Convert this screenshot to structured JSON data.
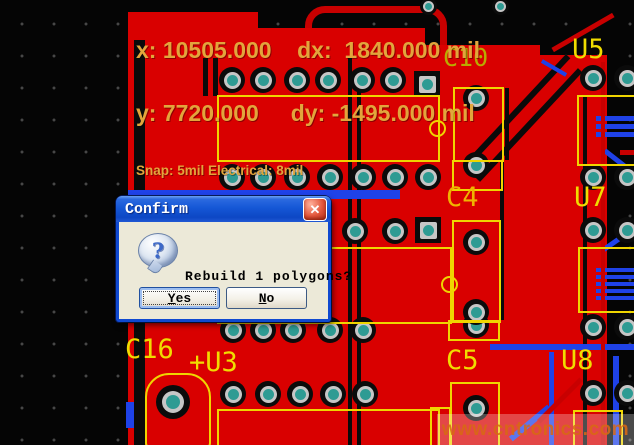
{
  "hud": {
    "line1": "x: 10505.000    dx:  1840.000 mil",
    "line2": "y: 7720.000     dy: -1495.000 mil",
    "line3": "Snap: 5mil Electrical: 8mil"
  },
  "dialog": {
    "title": "Confirm",
    "close_icon": "✕",
    "question_glyph": "?",
    "message": "Rebuild 1 polygons?",
    "yes_label": "Yes",
    "no_label": "No"
  },
  "watermark": {
    "text": "www.cntronics.com"
  },
  "colors": {
    "copper_pour": "#d90000",
    "silkscreen_yellow": "#efd500",
    "hud_text": "#e2a53c",
    "pad_teal": "#2e9b93",
    "trace_blue": "#1f42e8",
    "titlebar_blue": "#1557d6",
    "dialog_face": "#ece9d8"
  },
  "pcb": {
    "labels": [
      {
        "text": "C10",
        "x": 443,
        "y": 45,
        "size": 25,
        "color": "#b9ab00"
      },
      {
        "text": "U5",
        "x": 572,
        "y": 36,
        "size": 27,
        "color": "#f0dc00"
      },
      {
        "text": "C4",
        "x": 446,
        "y": 184,
        "size": 27,
        "color": "#efb400"
      },
      {
        "text": "U7",
        "x": 574,
        "y": 184,
        "size": 27,
        "color": "#f0dc00"
      },
      {
        "text": "C5",
        "x": 446,
        "y": 347,
        "size": 27,
        "color": "#f0dc00"
      },
      {
        "text": "U8",
        "x": 561,
        "y": 347,
        "size": 27,
        "color": "#f0dc00"
      },
      {
        "text": "C16",
        "x": 125,
        "y": 336,
        "size": 27,
        "color": "#f0dc00"
      },
      {
        "text": "+U3",
        "x": 189,
        "y": 349,
        "size": 27,
        "color": "#f0dc00"
      }
    ],
    "pads": [
      {
        "x": 232,
        "y": 80
      },
      {
        "x": 263,
        "y": 80
      },
      {
        "x": 297,
        "y": 80
      },
      {
        "x": 328,
        "y": 80
      },
      {
        "x": 362,
        "y": 80
      },
      {
        "x": 393,
        "y": 80
      },
      {
        "x": 427,
        "y": 84,
        "t": "square"
      },
      {
        "x": 593,
        "y": 78
      },
      {
        "x": 627,
        "y": 78
      },
      {
        "x": 232,
        "y": 177
      },
      {
        "x": 263,
        "y": 177
      },
      {
        "x": 297,
        "y": 177
      },
      {
        "x": 330,
        "y": 177
      },
      {
        "x": 363,
        "y": 177
      },
      {
        "x": 395,
        "y": 177
      },
      {
        "x": 428,
        "y": 177
      },
      {
        "x": 593,
        "y": 177
      },
      {
        "x": 627,
        "y": 177
      },
      {
        "x": 355,
        "y": 231
      },
      {
        "x": 395,
        "y": 231
      },
      {
        "x": 428,
        "y": 230,
        "t": "square"
      },
      {
        "x": 593,
        "y": 230
      },
      {
        "x": 627,
        "y": 230
      },
      {
        "x": 233,
        "y": 330
      },
      {
        "x": 263,
        "y": 330
      },
      {
        "x": 293,
        "y": 330
      },
      {
        "x": 330,
        "y": 330
      },
      {
        "x": 363,
        "y": 330
      },
      {
        "x": 476,
        "y": 325
      },
      {
        "x": 593,
        "y": 327
      },
      {
        "x": 627,
        "y": 327
      },
      {
        "x": 233,
        "y": 394
      },
      {
        "x": 268,
        "y": 394
      },
      {
        "x": 300,
        "y": 394
      },
      {
        "x": 333,
        "y": 394
      },
      {
        "x": 365,
        "y": 394
      },
      {
        "x": 593,
        "y": 393
      },
      {
        "x": 627,
        "y": 393
      },
      {
        "x": 476,
        "y": 98
      },
      {
        "x": 476,
        "y": 165
      },
      {
        "x": 476,
        "y": 242
      },
      {
        "x": 476,
        "y": 312
      },
      {
        "x": 476,
        "y": 408
      },
      {
        "x": 173,
        "y": 402,
        "t": "big"
      },
      {
        "x": 428,
        "y": 6,
        "t": "small"
      },
      {
        "x": 500,
        "y": 6,
        "t": "small"
      }
    ]
  }
}
